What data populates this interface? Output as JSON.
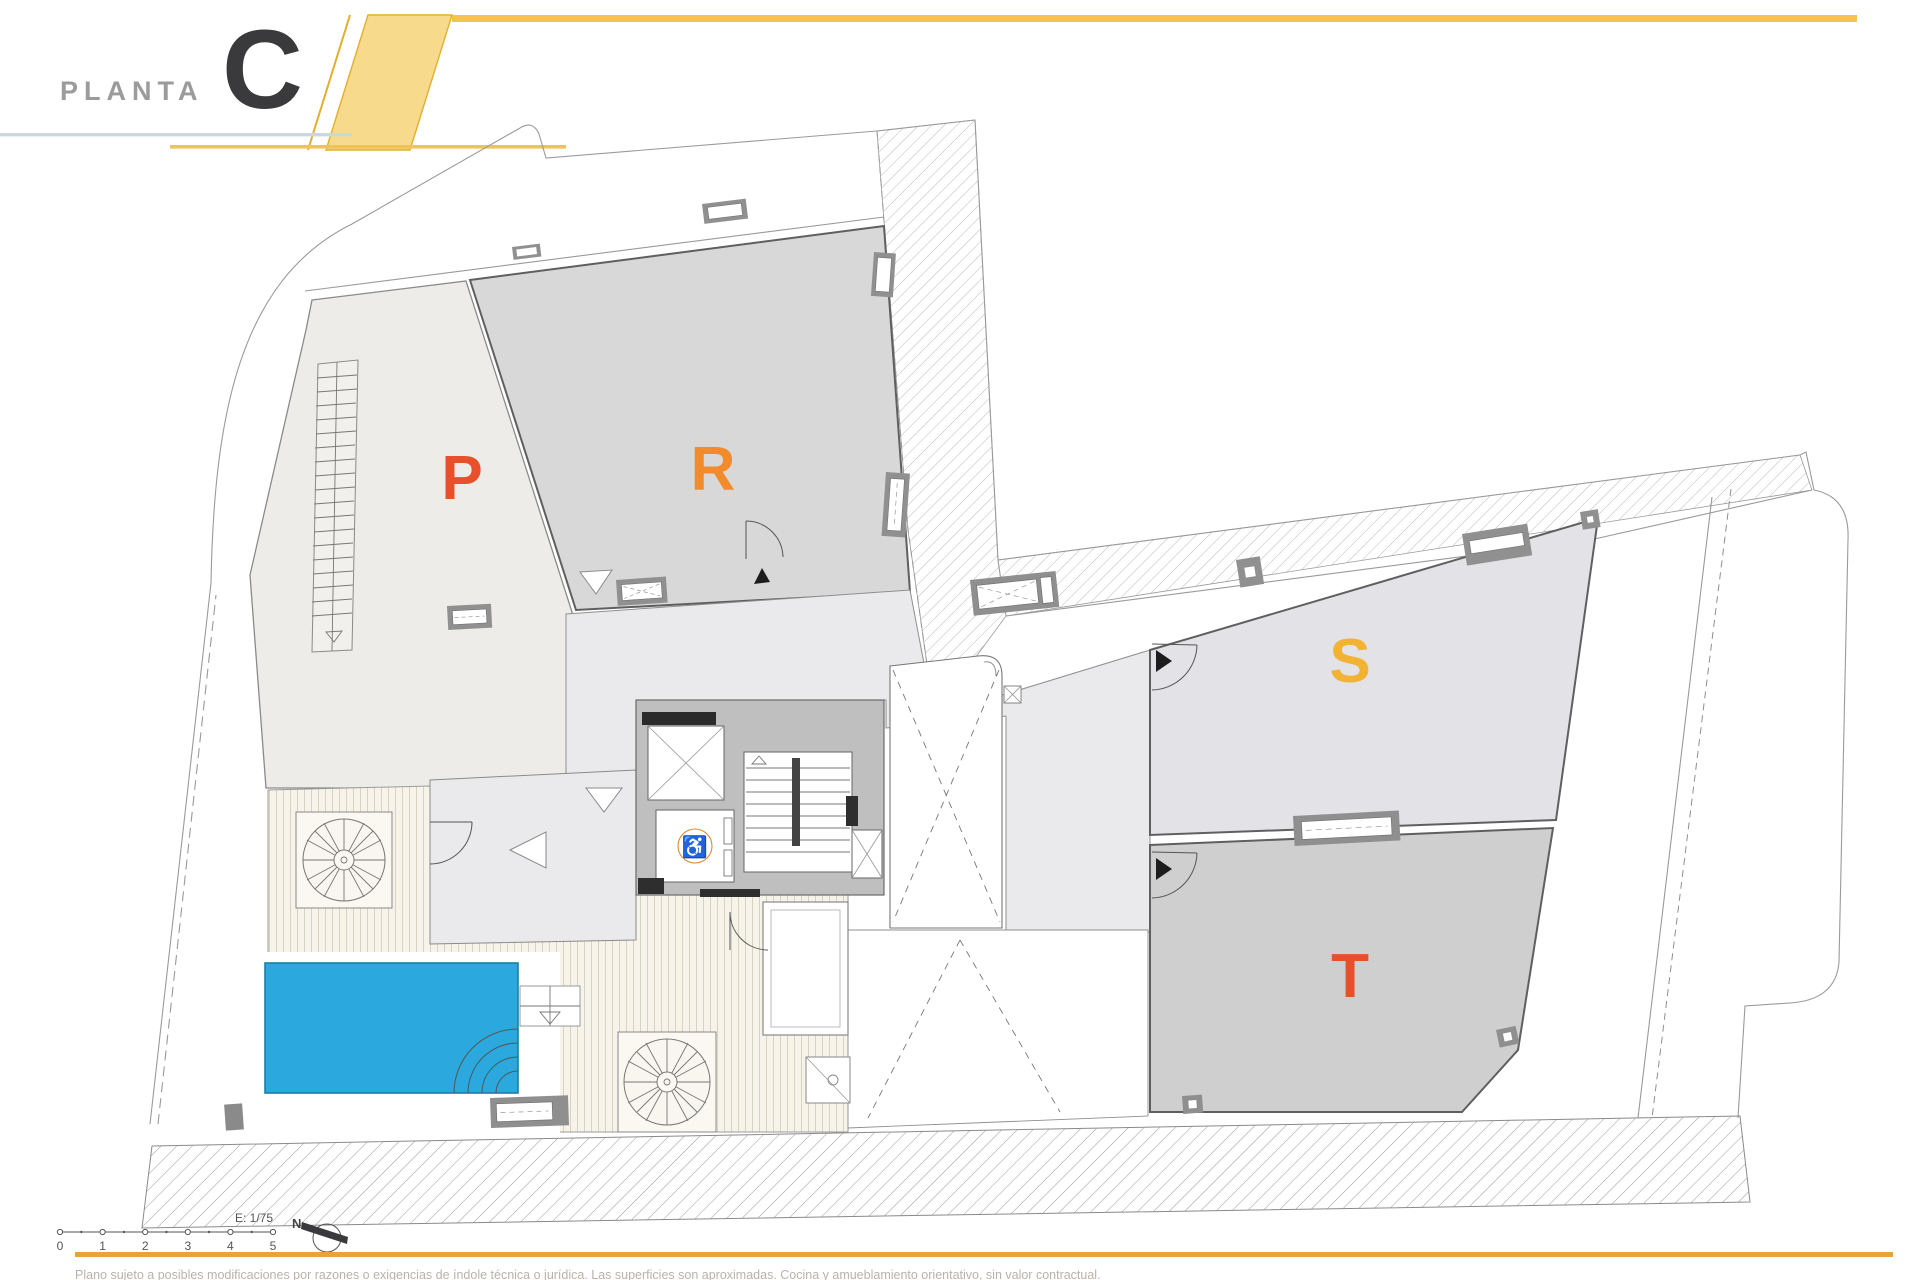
{
  "header": {
    "floor_label": "PLANTA",
    "floor_letter": "C",
    "accent_yellow": "#efc54f",
    "band_fill": "#f8da8c",
    "band_border": "#e2af2d"
  },
  "plan": {
    "units": [
      {
        "id": "P",
        "label": "P",
        "color": "#e8502b"
      },
      {
        "id": "R",
        "label": "R",
        "color": "#f28b2b"
      },
      {
        "id": "S",
        "label": "S",
        "color": "#f2b233"
      },
      {
        "id": "T",
        "label": "T",
        "color": "#e8502b"
      }
    ],
    "accessible_lift_icon": "♿",
    "pool_color": "#2ba9de",
    "neighbor_hatch": "diagonal-lines",
    "street_hatch": "diagonal-lines"
  },
  "scalebar": {
    "scale_label": "E: 1/75",
    "ticks": [
      "0",
      "1",
      "2",
      "3",
      "4",
      "5"
    ]
  },
  "compass": {
    "north_label": "N"
  },
  "footer": {
    "disclaimer": "Plano sujeto a posibles modificaciones por razones o exigencias de índole técnica o jurídica. Las superficies son aproximadas. Cocina y amueblamiento orientativo, sin valor contractual."
  }
}
